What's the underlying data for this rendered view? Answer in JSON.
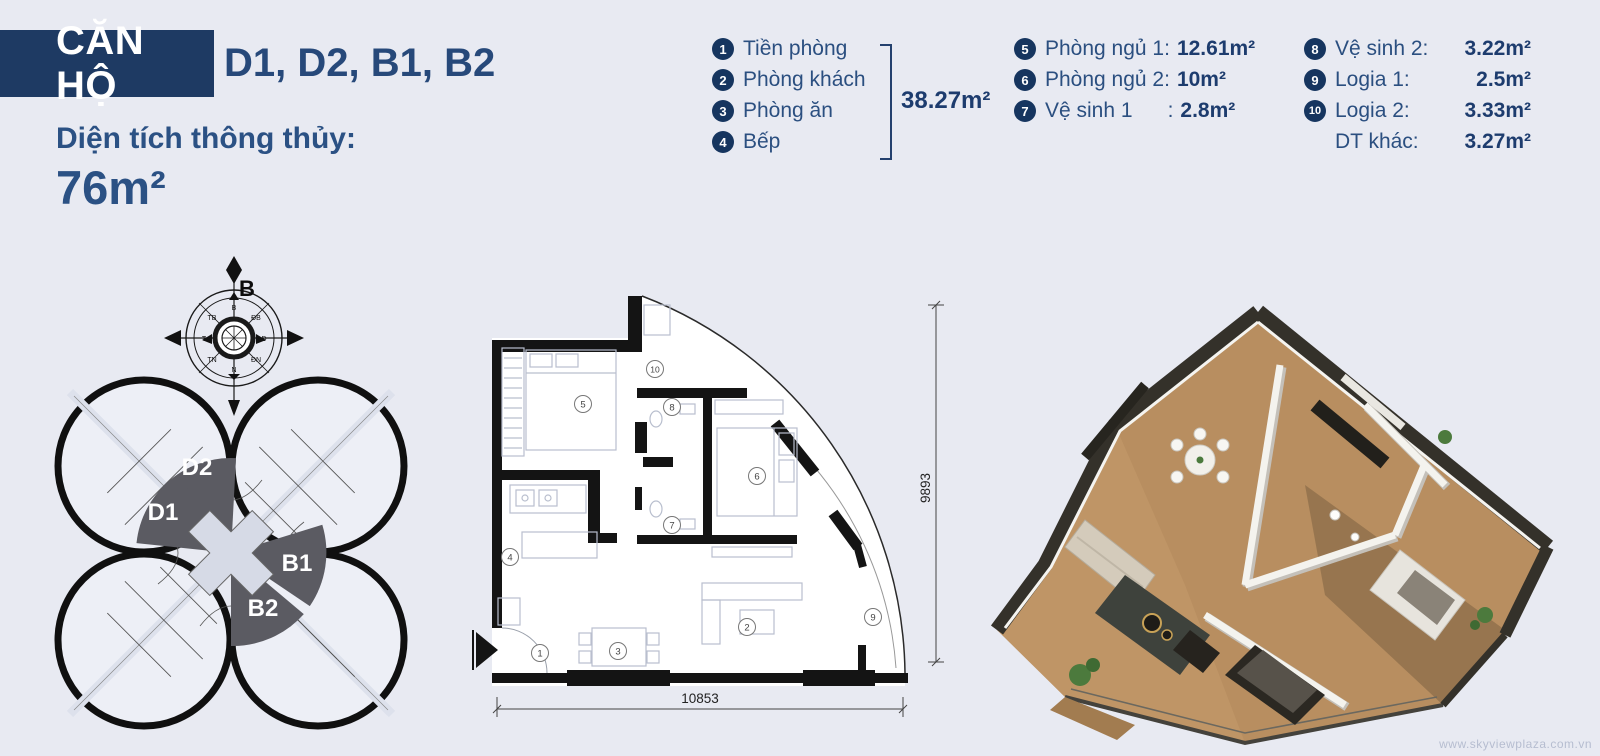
{
  "header": {
    "badge": "CĂN HỘ",
    "units": "D1, D2, B1, B2",
    "area_label": "Diện tích thông thủy:",
    "area_value": "76m²"
  },
  "legend": {
    "group1": {
      "items": [
        {
          "num": "1",
          "label": "Tiền phòng"
        },
        {
          "num": "2",
          "label": "Phòng khách"
        },
        {
          "num": "3",
          "label": "Phòng ăn"
        },
        {
          "num": "4",
          "label": "Bếp"
        }
      ],
      "area": "38.27m²"
    },
    "group2": {
      "items": [
        {
          "num": "5",
          "label": "Phòng ngủ 1:",
          "value": "12.61m²"
        },
        {
          "num": "6",
          "label": "Phòng ngủ 2:",
          "value": "10m²"
        },
        {
          "num": "7",
          "label": "Vệ sinh 1      :",
          "value": "2.8m²"
        }
      ]
    },
    "group3": {
      "items": [
        {
          "num": "8",
          "label": "Vệ sinh 2:",
          "value": "3.22m²"
        },
        {
          "num": "9",
          "label": "Logia 1:",
          "value": "2.5m²"
        },
        {
          "num": "10",
          "label": "Logia 2:",
          "value": "3.33m²"
        },
        {
          "num": "",
          "label": "DT khác:",
          "value": "3.27m²"
        }
      ]
    }
  },
  "site_plan": {
    "compass_main": "B",
    "compass_points": [
      "B",
      "ĐB",
      "Đ",
      "ĐN",
      "N",
      "TN",
      "T",
      "TB"
    ],
    "unit_labels": [
      "D2",
      "D1",
      "B1",
      "B2"
    ]
  },
  "floor_plan": {
    "rooms": [
      {
        "num": "1"
      },
      {
        "num": "2"
      },
      {
        "num": "3"
      },
      {
        "num": "4"
      },
      {
        "num": "5"
      },
      {
        "num": "6"
      },
      {
        "num": "7"
      },
      {
        "num": "8"
      },
      {
        "num": "9"
      },
      {
        "num": "10"
      }
    ],
    "dim_width": "10853",
    "dim_height": "9893"
  },
  "footer": {
    "watermark": "www.skyviewplaza.com.vn"
  },
  "colors": {
    "background": "#e8eaf2",
    "navy_dark": "#1e3a63",
    "navy_text": "#2b4f80",
    "badge_fill": "#16355f",
    "wedge_gray": "#5b5b62",
    "wall_black": "#141414",
    "wood_floor": "#b88e60"
  }
}
